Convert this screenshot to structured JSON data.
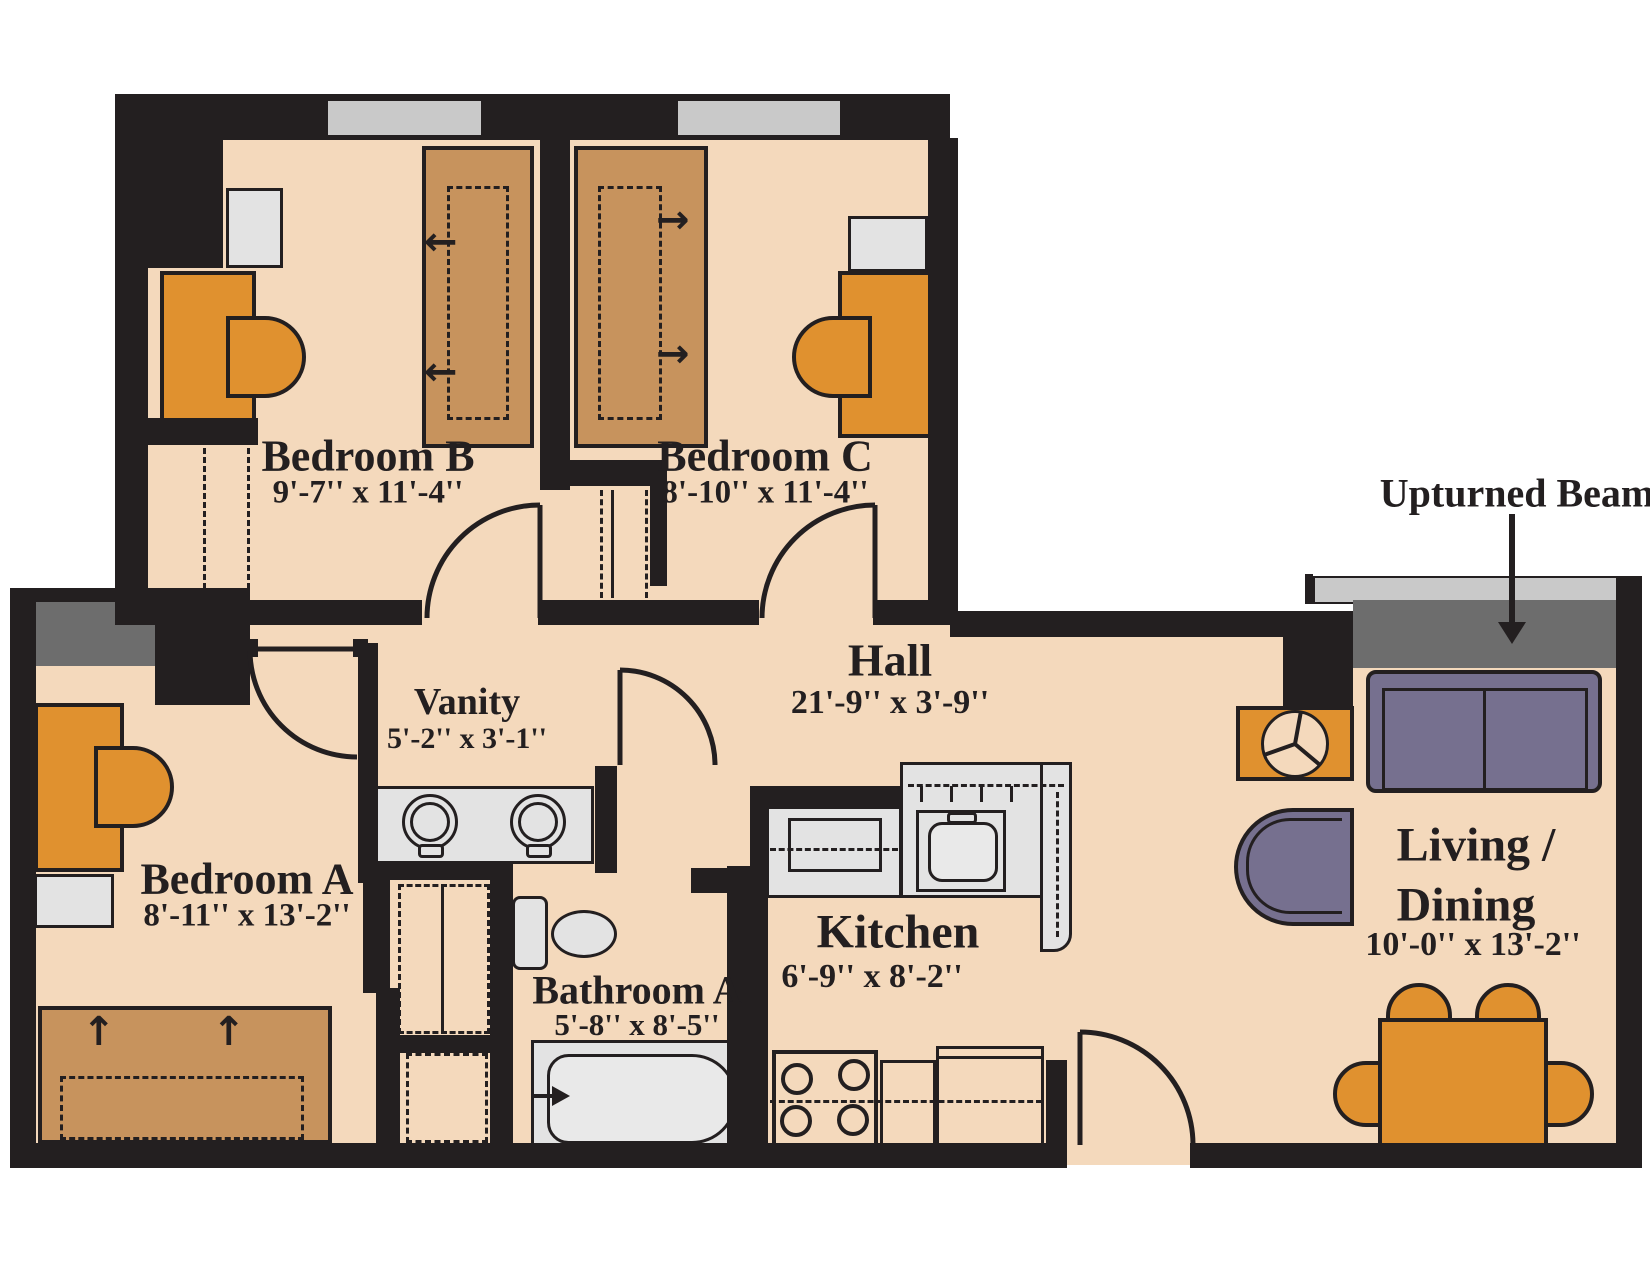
{
  "title": "Apartment floor plan",
  "rooms": [
    {
      "id": "bedroom-b",
      "name": "Bedroom B",
      "dims": "9'-7'' x 11'-4''"
    },
    {
      "id": "bedroom-c",
      "name": "Bedroom C",
      "dims": "8'-10'' x 11'-4''"
    },
    {
      "id": "bedroom-a",
      "name": "Bedroom A",
      "dims": "8'-11'' x 13'-2''"
    },
    {
      "id": "vanity",
      "name": "Vanity",
      "dims": "5'-2'' x 3'-1''"
    },
    {
      "id": "hall",
      "name": "Hall",
      "dims": "21'-9'' x 3'-9''"
    },
    {
      "id": "bathroom-a",
      "name": "Bathroom A",
      "dims": "5'-8'' x 8'-5''"
    },
    {
      "id": "kitchen",
      "name": "Kitchen",
      "dims": "6'-9'' x 8'-2''"
    },
    {
      "id": "living-dining",
      "name_line1": "Living /",
      "name_line2": "Dining",
      "dims": "10'-0'' x 13'-2''"
    }
  ],
  "annotation": {
    "label": "Upturned Beam"
  },
  "icons": {
    "arrow_left": "←",
    "arrow_right": "→",
    "arrow_up": "↑"
  },
  "colors": {
    "floor": "#f4d9bc",
    "wall": "#231f20",
    "furniture_orange": "#e0912f",
    "bed_brown": "#c7935d",
    "fixture_gray": "#e3e3e3",
    "window_gray": "#c9c9c9",
    "beam_dark": "#6d6d6d",
    "upholstery_purple": "#76708f"
  }
}
